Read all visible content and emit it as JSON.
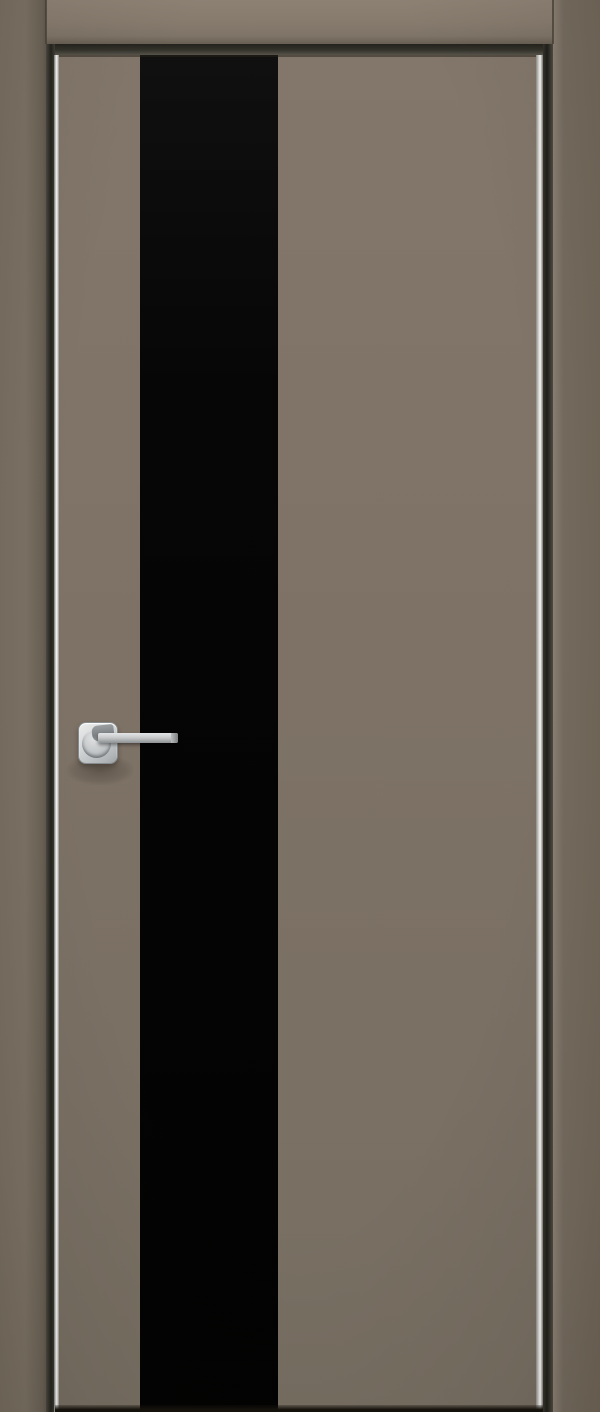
{
  "scene": {
    "label": "Product photo of a closed modern interior door, taupe finish, vertical black glass stripe, chrome lever handle",
    "parts": {
      "frame_head": "door frame head jamb",
      "frame_jamb_left": "door frame left jamb",
      "frame_jamb_right": "door frame right jamb",
      "door_leaf": "taupe flush door leaf",
      "glass_stripe": "full-height black glass insert stripe",
      "aluminum_edge_left": "polished aluminum edge strip, hinge side",
      "aluminum_edge_right": "polished aluminum edge strip, lock side",
      "handle": "square-rosette satin chrome lever handle",
      "floor_shadow": "shadow under the door leaf"
    }
  },
  "colors": {
    "wall_frame": "#776d60",
    "jamb_left": "#786e61",
    "jamb_right": "#756b5f",
    "lintel": "#877b6e",
    "door_face": "#7e7266",
    "glass_stripe": "#020202",
    "aluminum_edge": "#fafafa",
    "reveal_shadow": "#23221c",
    "handle_chrome": "#d3d6d7",
    "bottom_shadow": "#15120c"
  }
}
